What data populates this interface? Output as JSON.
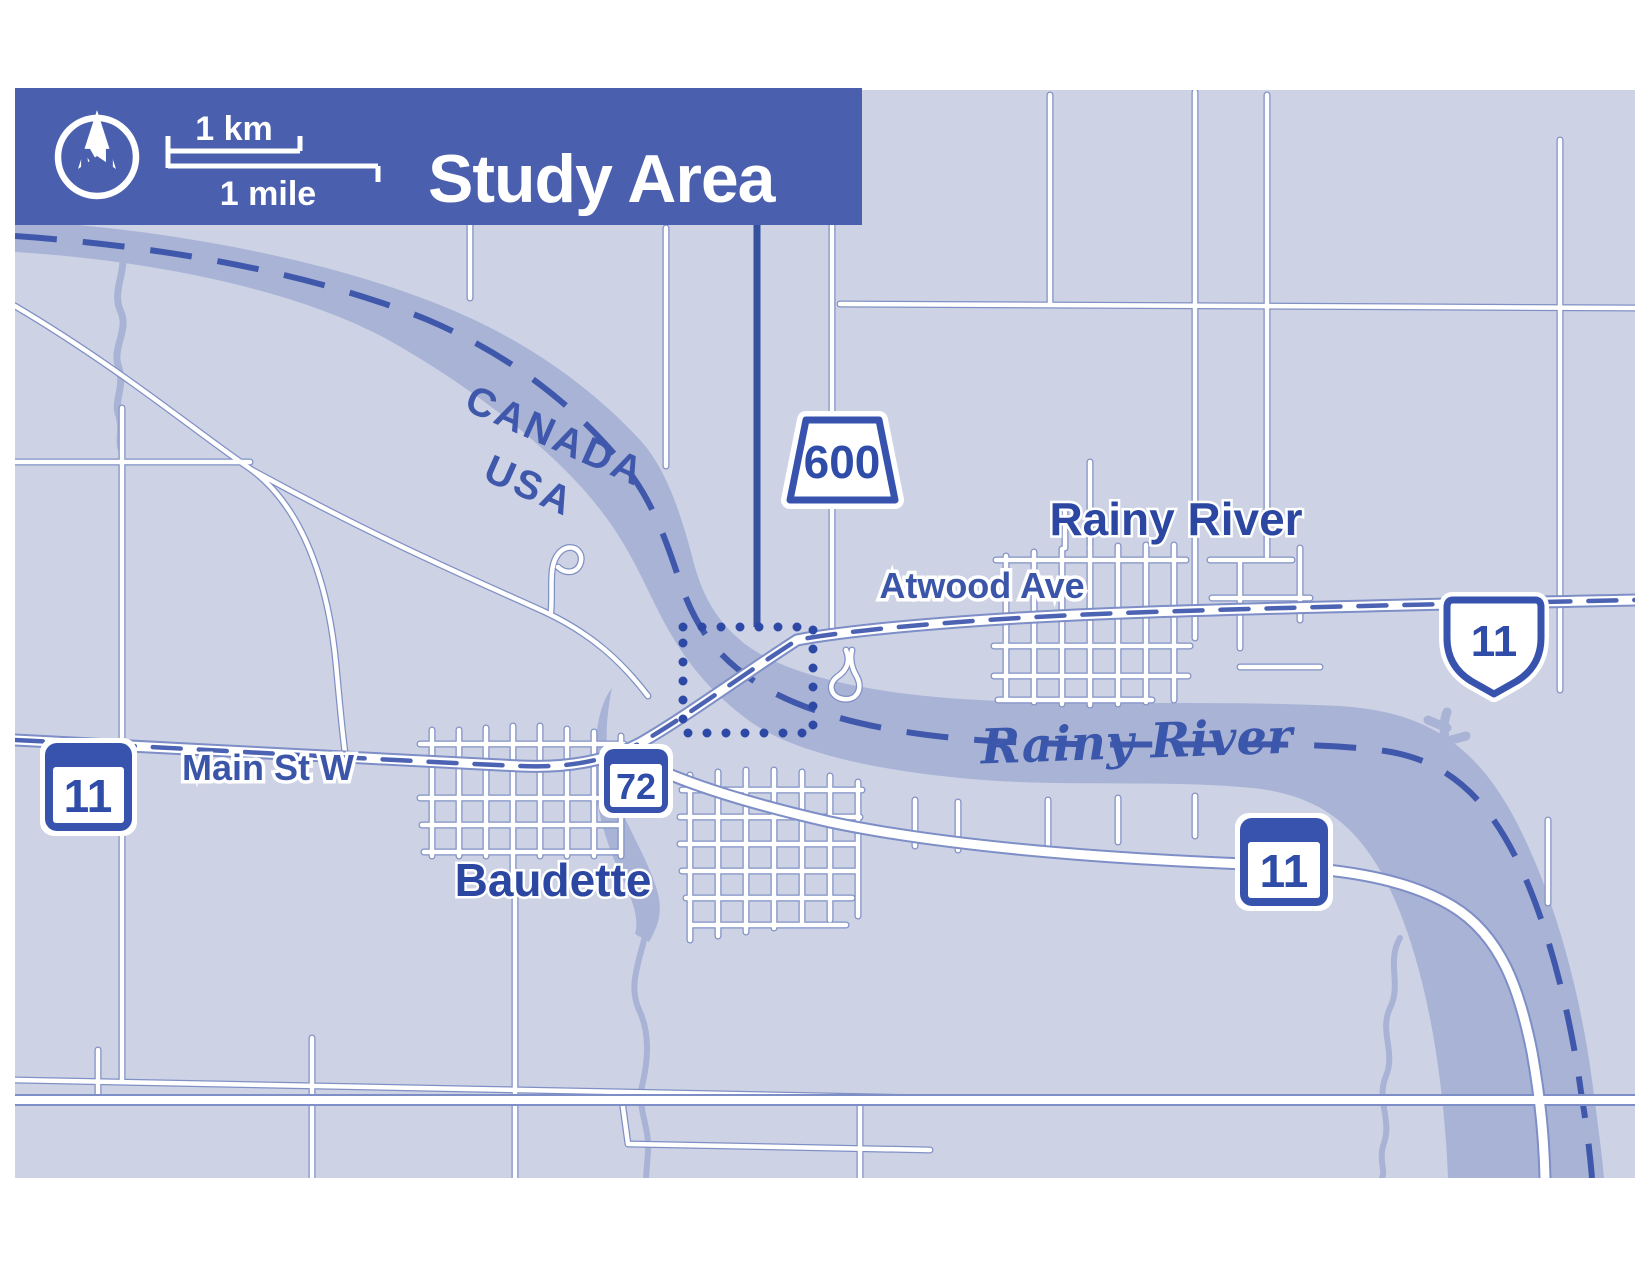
{
  "header": {
    "title": "Study Area",
    "north_label": "N",
    "scale": {
      "km": "1 km",
      "mile": "1 mile"
    },
    "bg_color": "#4a5fae"
  },
  "map": {
    "country_labels": {
      "canada": "CANADA",
      "usa": "USA"
    },
    "towns": {
      "rainy_river": "Rainy River",
      "baudette": "Baudette"
    },
    "streets": {
      "atwood": "Atwood Ave",
      "main_st": "Main St W"
    },
    "waterways": {
      "rainy_river": "Rainy River"
    },
    "shields": {
      "on600": "600",
      "on11": "11",
      "mn11_west": "11",
      "mn72": "72",
      "mn11_south": "11"
    },
    "colors": {
      "map_bg": "#cdd3e5",
      "river": "#a9b3d6",
      "road_casing": "#8090c4",
      "highway_casing": "#7e8ec6",
      "route_dash": "#4c63b3",
      "border_dash": "#4058ab",
      "label_blue": "#2f4da8",
      "shield_blue": "#3753ae",
      "study_box": "#2d49a5"
    }
  }
}
